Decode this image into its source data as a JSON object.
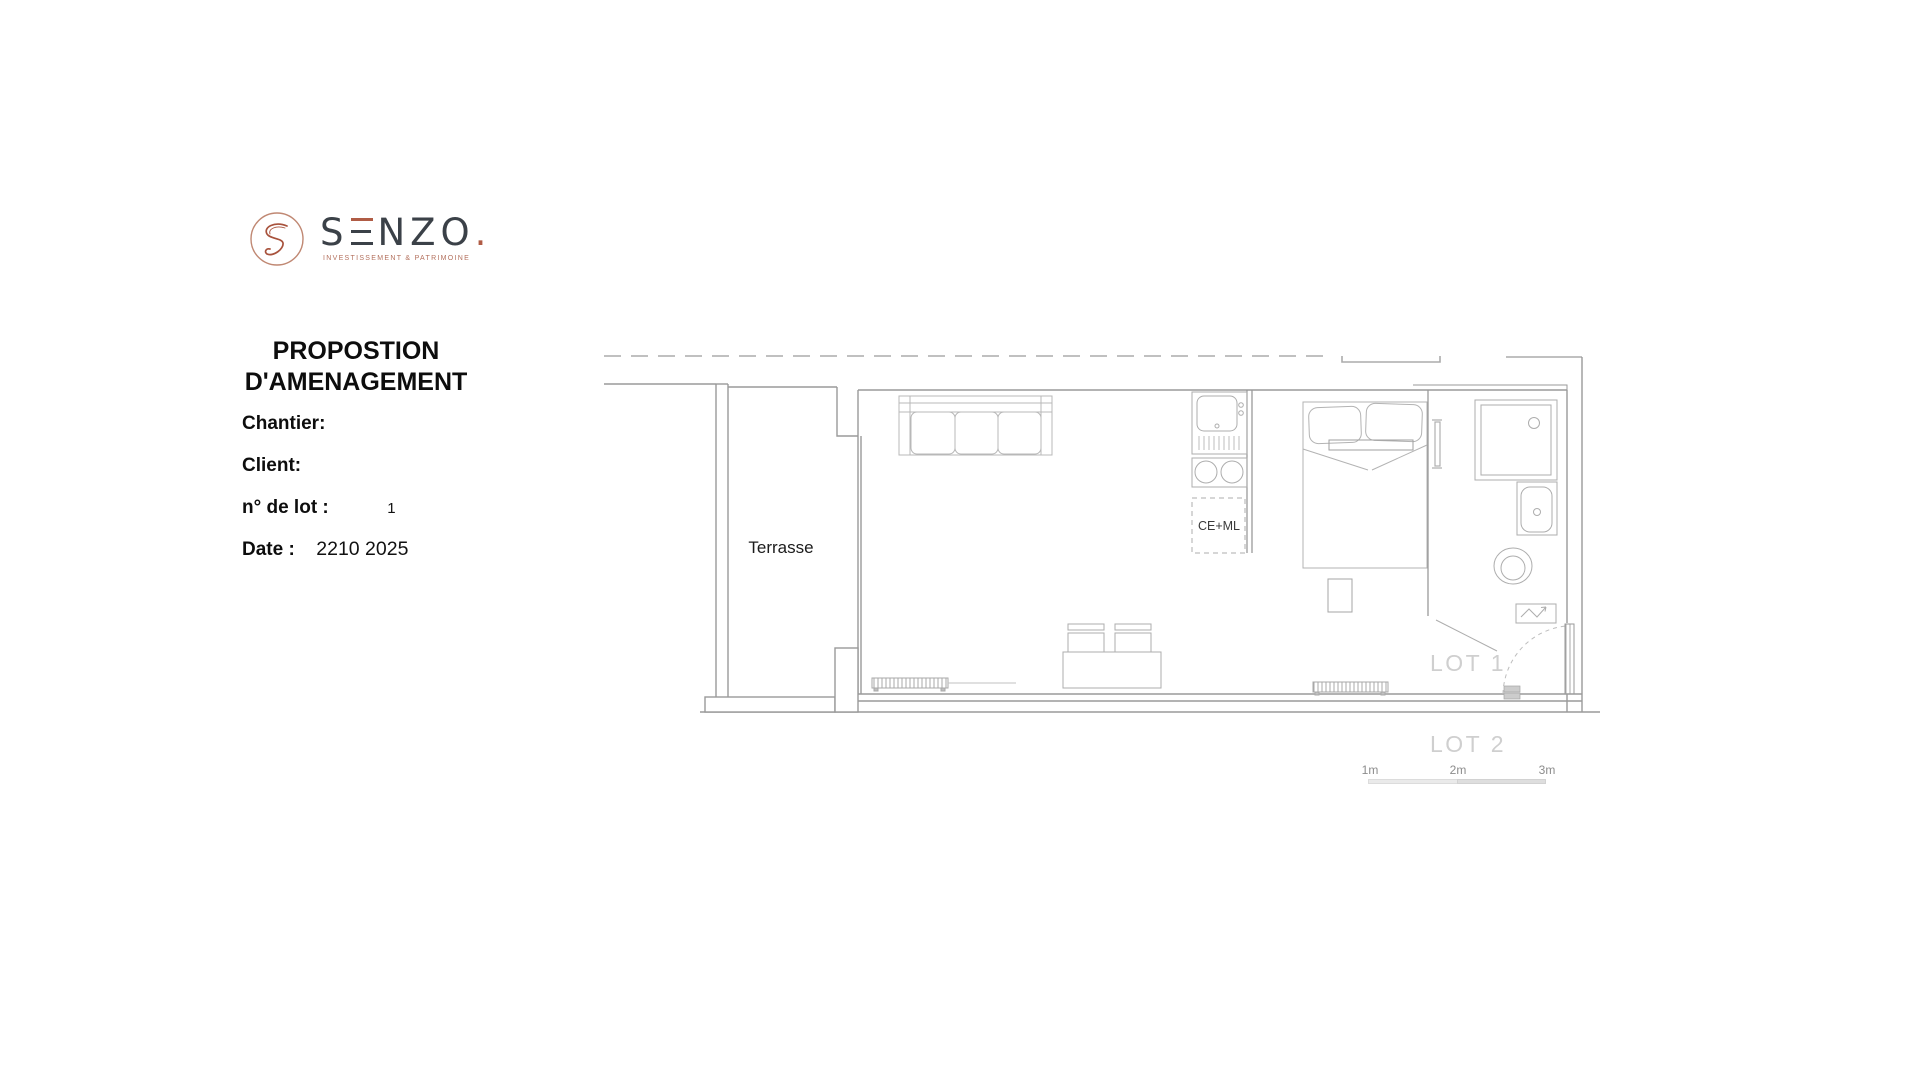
{
  "colors": {
    "copper_accent": "#b05c45",
    "wordmark_dark": "#3b4148",
    "wall_line": "#9a9a9a",
    "furniture_line": "#b3b3b3",
    "lot_text": "#cfcfcf",
    "scale_text": "#8c8c8c"
  },
  "logo": {
    "brand_s": "S",
    "brand_nzo": "NZO",
    "dot": ".",
    "tagline": "INVESTISSEMENT & PATRIMOINE"
  },
  "header": {
    "title_line1": "PROPOSTION",
    "title_line2": "D'AMENAGEMENT"
  },
  "fields": [
    {
      "label": "Chantier:",
      "value": ""
    },
    {
      "label": "Client:",
      "value": ""
    },
    {
      "label": "n° de lot :",
      "value": "1"
    },
    {
      "label": "Date :",
      "value": "2210 2025"
    }
  ],
  "plan": {
    "terrasse_label": "Terrasse",
    "kitchen_label": "CE+ML",
    "lot1_label": "LOT 1",
    "lot2_label": "LOT 2",
    "scale": {
      "m1": "1m",
      "m2": "2m",
      "m3": "3m"
    }
  }
}
